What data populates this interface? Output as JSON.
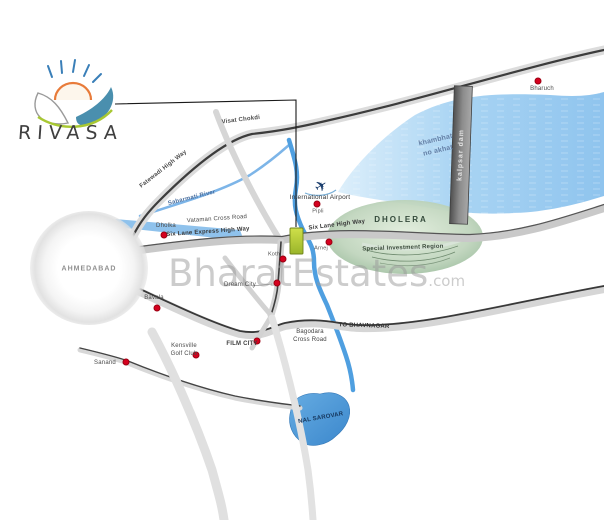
{
  "logo": {
    "text": "RIVASA"
  },
  "watermark": {
    "text": "BharatEstates",
    "suffix": ".com"
  },
  "map": {
    "labels": {
      "ahmedabad": "AHMEDABAD",
      "visat_chokdi": "Visat Chokdi",
      "fatewadi_highway": "Fatewadi High Way",
      "sabarmati_river": "Sabarmati River",
      "dholka": "Dholka",
      "vataman": "Vataman Cross Road",
      "six_lane_express": "Six Lane Express High Way",
      "six_lane": "Six Lane High Way",
      "international_airport": "International Airport",
      "pipli": "Pipli",
      "arnej": "Arnej",
      "koth": "Koth",
      "dholera": "DHOLERA",
      "sir": "Special Investment Region",
      "gulf": "khambhat\nno akhat",
      "kalpsar_dam": "kalpsar dam",
      "bharuch": "Bharuch",
      "bavla": "Bavala",
      "dream_city": "Dream City",
      "film_city": "FILM CITY",
      "kensville": "Kensville\nGolf Club",
      "sanand": "Sanand",
      "bagodara": "Bagodara\nCross Road",
      "to_bhavnagar": "TO BHAVNAGAR",
      "nal_sarovar": "NAL SAROVAR"
    },
    "colors": {
      "water": "#8fc4ee",
      "river": "#4f9fe0",
      "road": "#d4d4d4",
      "highway_line": "#3c3c3c",
      "marker_green": "#b5cf35",
      "dot_red": "#d5001e",
      "region_green": "#b3cbb0",
      "watermark_gray": "#9a9a9a"
    }
  }
}
